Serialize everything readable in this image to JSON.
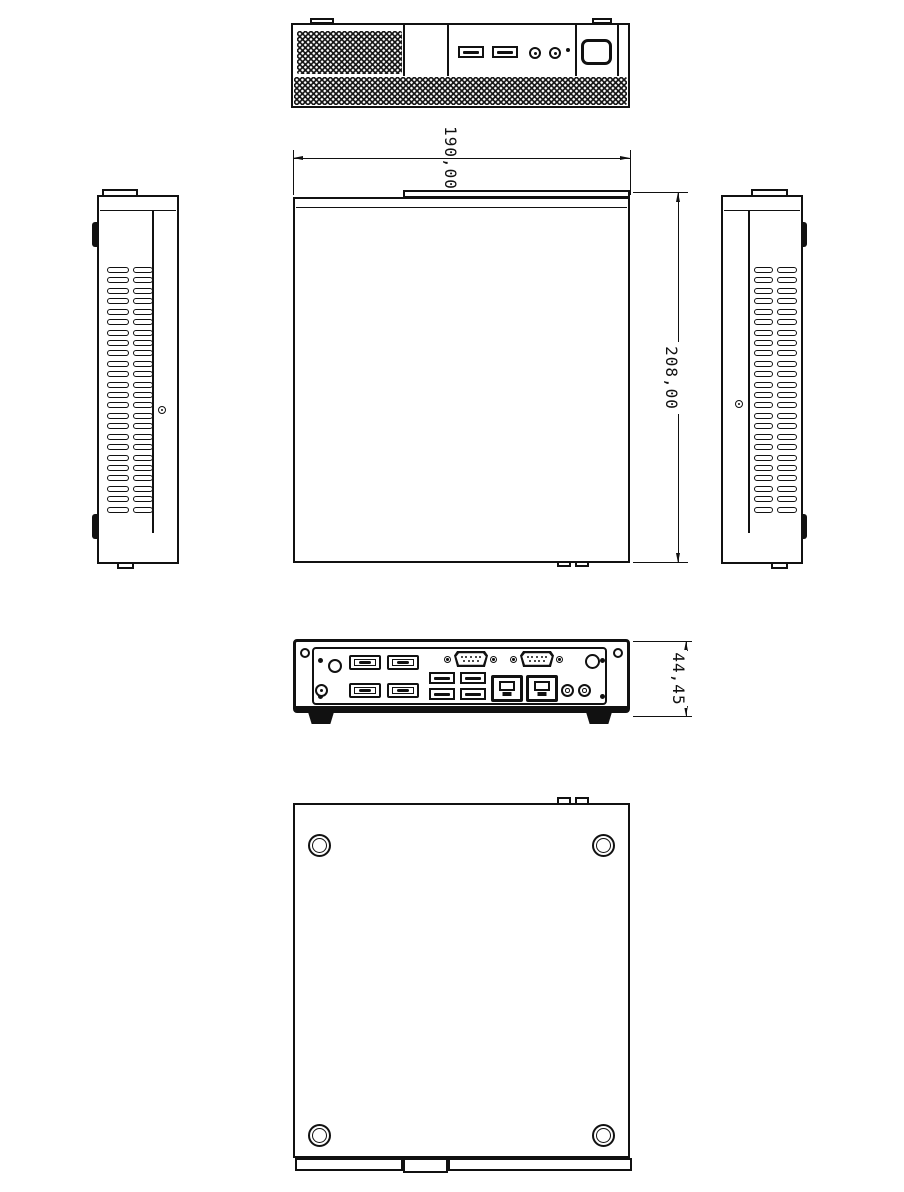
{
  "colors": {
    "background": "#ffffff",
    "line": "#111111"
  },
  "dimension_labels": {
    "width": "190,00",
    "depth": "208,00",
    "height": "44,45"
  },
  "views": {
    "front": {
      "usb_ports": 2,
      "audio_jacks": 2,
      "power_button": 1,
      "status_led": 1
    },
    "left_side": {
      "vent_columns": 2,
      "vent_rows": 24
    },
    "right_side": {
      "vent_columns": 2,
      "vent_rows": 24
    },
    "rear": {
      "display_ports": 4,
      "usb_ports": 4,
      "serial_ports": 2,
      "serial_pins_top": 5,
      "serial_pins_bottom": 4,
      "ethernet_ports": 2,
      "audio_jacks": 2
    },
    "bottom": {
      "mounting_holes": 4
    }
  }
}
